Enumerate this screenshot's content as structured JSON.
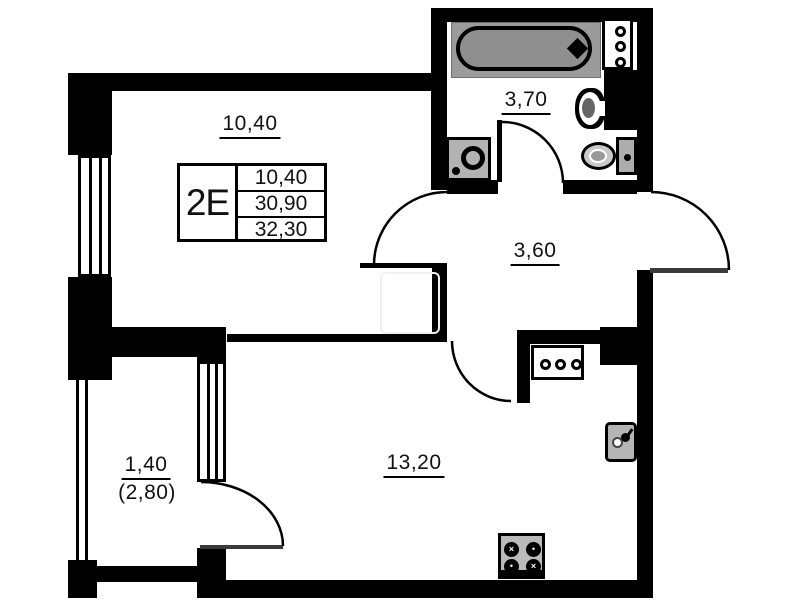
{
  "unit": {
    "type_label": "2E",
    "area_rows": [
      "10,40",
      "30,90",
      "32,30"
    ]
  },
  "rooms": {
    "bedroom": {
      "area": "10,40"
    },
    "bathroom": {
      "area": "3,70"
    },
    "hallway": {
      "area": "3,60"
    },
    "living_kitchen": {
      "area": "13,20"
    },
    "balcony": {
      "area": "1,40",
      "area_total": "(2,80)"
    }
  }
}
